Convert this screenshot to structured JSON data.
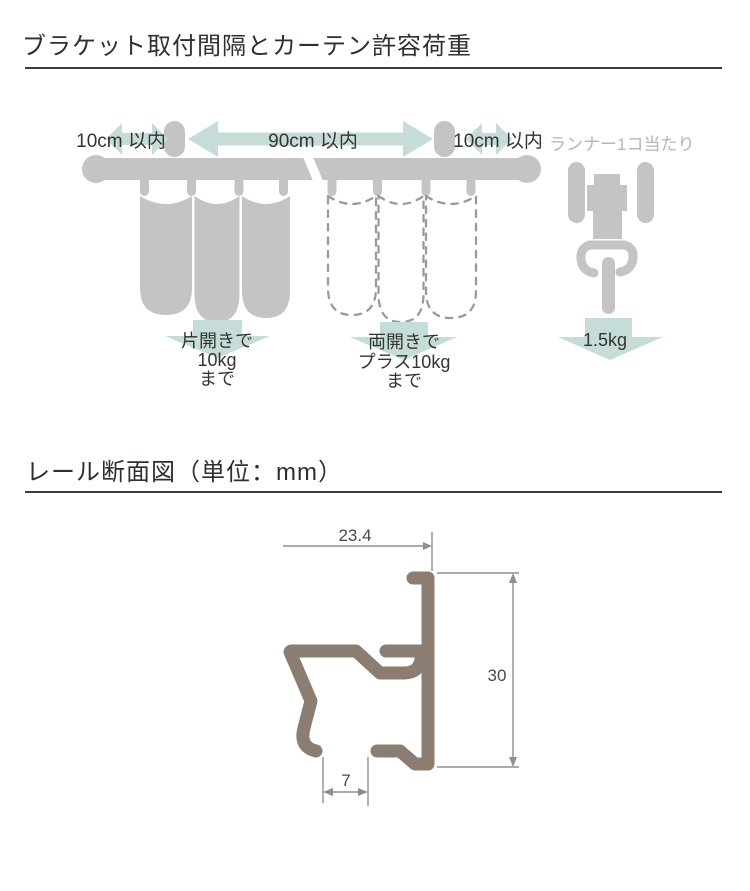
{
  "section1": {
    "title": "ブラケット取付間隔とカーテン許容荷重",
    "span_left": "10cm 以内",
    "span_center": "90cm 以内",
    "span_right": "10cm 以内",
    "runner_caption": "ランナー1コ当たり",
    "left_load": {
      "l1": "片開きで",
      "l2": "10kg",
      "l3": "まで"
    },
    "right_load": {
      "l1": "両開きで",
      "l2": "プラス10kg",
      "l3": "まで"
    },
    "runner_load": "1.5kg"
  },
  "section2": {
    "title": "レール断面図（単位：mm）",
    "dim_width": "23.4",
    "dim_height": "30",
    "dim_slot": "7"
  },
  "colors": {
    "shape_gray": "#c4c4c6",
    "arrow_teal": "#c5dcd8",
    "dashed_outline": "#9a9a9a",
    "profile_taupe": "#8b7d72",
    "dimension_line": "#8f8f8f",
    "text_dark": "#333333",
    "text_gray": "#b5b5b7",
    "title_color": "#332e2b",
    "rule_color": "#413b38"
  }
}
